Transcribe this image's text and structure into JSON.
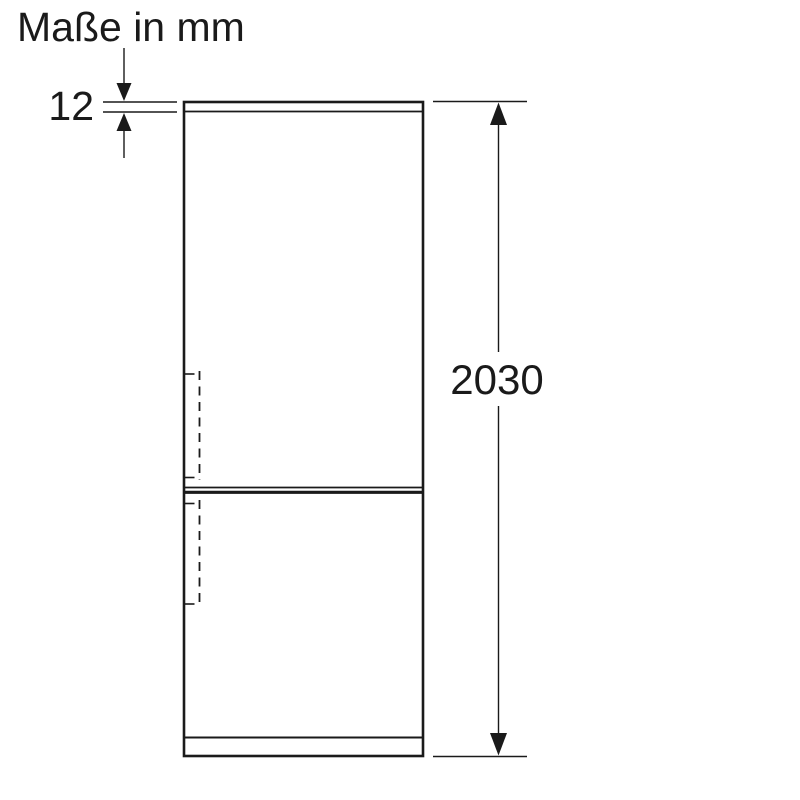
{
  "title": "Maße in mm",
  "dimensions": {
    "top_panel_thickness_mm": "12",
    "overall_height_mm": "2030"
  },
  "colors": {
    "line": "#1a1a1a",
    "text": "#1a1a1a",
    "background": "#ffffff"
  }
}
